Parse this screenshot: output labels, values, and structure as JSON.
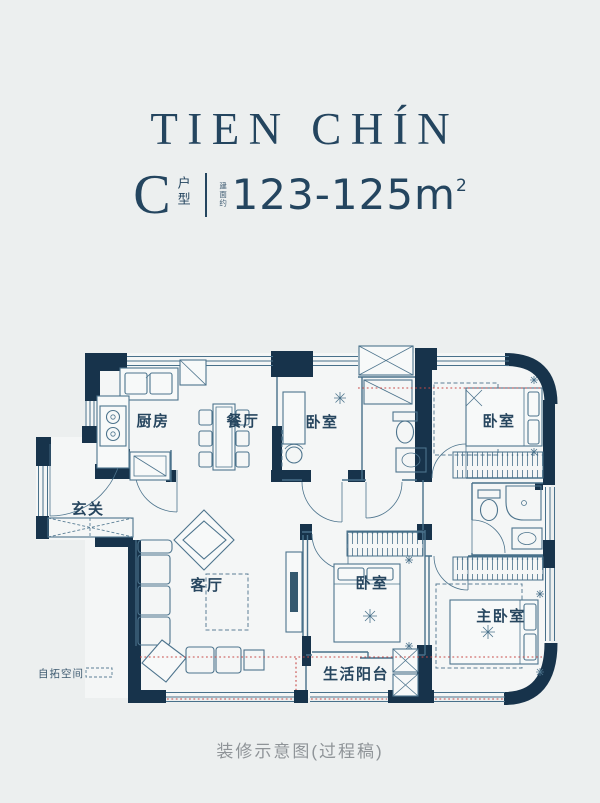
{
  "header": {
    "title": "TIEN CHÍN",
    "unit_letter": "C",
    "unit_suffix": "户型",
    "area_prefix": "建面约",
    "area_value": "123-125m",
    "area_superscript": "2"
  },
  "plan": {
    "rooms": [
      {
        "id": "kitchen",
        "label": "厨房"
      },
      {
        "id": "dining-room",
        "label": "餐厅"
      },
      {
        "id": "bedroom-north",
        "label": "卧室"
      },
      {
        "id": "bedroom-east",
        "label": "卧室"
      },
      {
        "id": "foyer",
        "label": "玄关"
      },
      {
        "id": "living-room",
        "label": "客厅"
      },
      {
        "id": "bedroom-south",
        "label": "卧室"
      },
      {
        "id": "master-bedroom",
        "label": "主卧室"
      },
      {
        "id": "balcony",
        "label": "生活阳台"
      },
      {
        "id": "expansion-space",
        "label": "自拓空间"
      }
    ],
    "colors": {
      "wall": "#17334b",
      "line": "#48708a",
      "red_guide": "#c84a48",
      "label_text": "#27465f",
      "background": "#ecefef"
    }
  },
  "footer": {
    "caption": "装修示意图(过程稿)"
  }
}
